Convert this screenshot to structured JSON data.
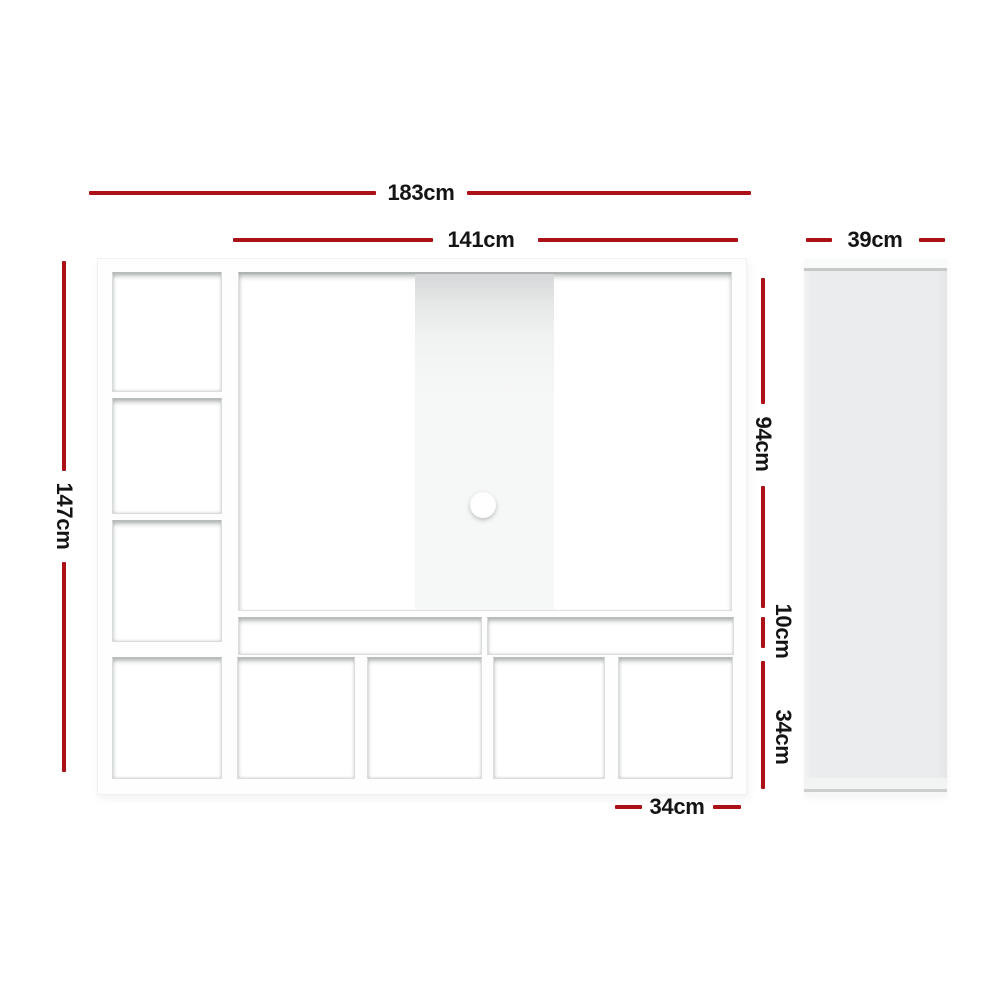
{
  "diagram": {
    "accent_color": "#AB1116",
    "text_color": "#141414",
    "unit_color": "#ffffff",
    "side_panel_color": "#ebeced",
    "dimensions": {
      "total_width": "183cm",
      "tv_opening_width": "141cm",
      "side_panel_depth": "39cm",
      "total_height": "147cm",
      "tv_opening_height": "94cm",
      "media_shelf_height": "10cm",
      "bottom_row_height": "34cm",
      "media_shelf_width": "70cm",
      "bottom_cubby_width": "34cm"
    }
  }
}
